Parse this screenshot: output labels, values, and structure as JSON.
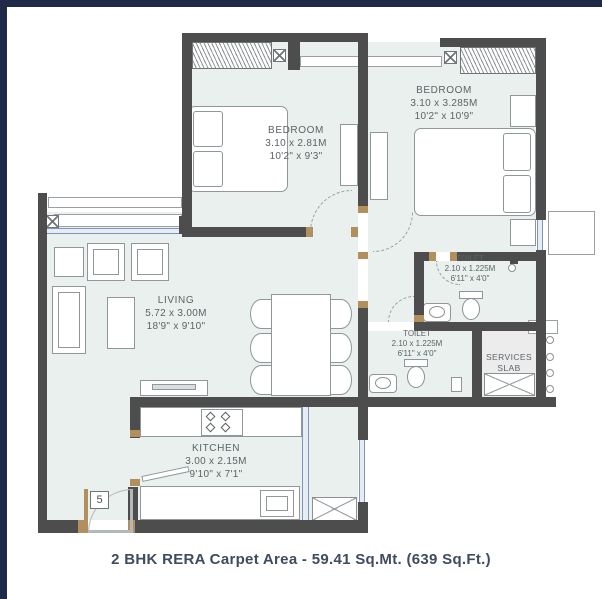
{
  "plan": {
    "rooms": {
      "bedroom1": {
        "name": "BEDROOM",
        "dim_m": "3.10 x 2.81M",
        "dim_ft": "10'2\" x 9'3\""
      },
      "bedroom2": {
        "name": "BEDROOM",
        "dim_m": "3.10 x 3.285M",
        "dim_ft": "10'2\" x 10'9\""
      },
      "living": {
        "name": "LIVING",
        "dim_m": "5.72 x 3.00M",
        "dim_ft": "18'9\" x 9'10\""
      },
      "kitchen": {
        "name": "KITCHEN",
        "dim_m": "3.00 x 2.15M",
        "dim_ft": "9'10\" x 7'1\""
      },
      "toilet1": {
        "name": "TOILET",
        "dim_m": "2.10 x 1.225M",
        "dim_ft": "6'11\" x 4'0\""
      },
      "toilet2": {
        "name": "TOILET",
        "dim_m": "2.10 x 1.225M",
        "dim_ft": "6'11\" x 4'0\""
      },
      "services": {
        "line1": "SERVICES",
        "line2": "SLAB"
      }
    },
    "entrance_number": "5",
    "caption": "2 BHK RERA Carpet Area - 59.41 Sq.Mt. (639 Sq.Ft.)",
    "colors": {
      "frame": "#1e2a47",
      "wall": "#4d4d4d",
      "floor": "#e9f0ee",
      "glass": "#8095ba",
      "door_frame": "#b2905e",
      "label_text": "#5d6366",
      "caption_text": "#3f4c5d"
    }
  }
}
